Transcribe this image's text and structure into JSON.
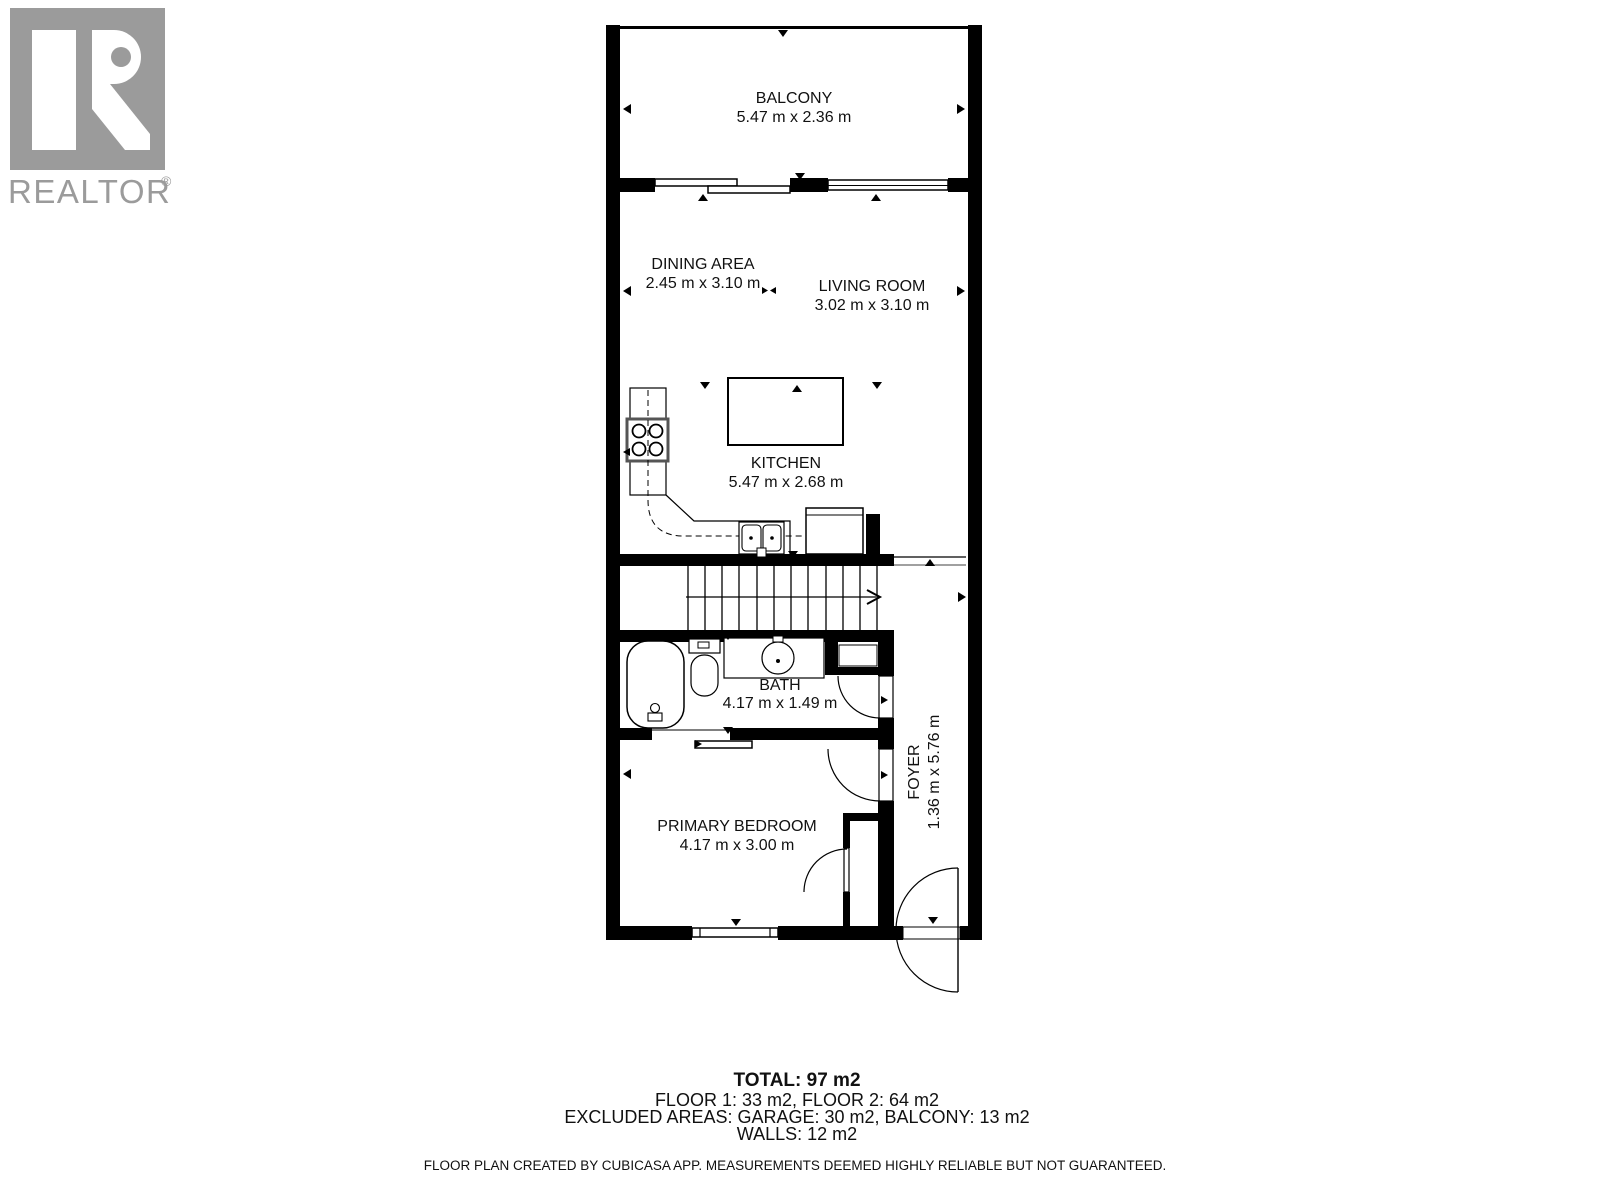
{
  "logo": {
    "brand": "REALTOR",
    "registered": "®",
    "color": "#9b9b9b"
  },
  "rooms": [
    {
      "name": "BALCONY",
      "dims": "5.47 m x 2.36 m"
    },
    {
      "name": "DINING AREA",
      "dims": "2.45 m x 3.10 m"
    },
    {
      "name": "LIVING ROOM",
      "dims": "3.02 m x 3.10 m"
    },
    {
      "name": "KITCHEN",
      "dims": "5.47 m x 2.68 m"
    },
    {
      "name": "BATH",
      "dims": "4.17 m x 1.49 m"
    },
    {
      "name": "FOYER",
      "dims": "1.36 m x 5.76 m"
    },
    {
      "name": "PRIMARY BEDROOM",
      "dims": "4.17 m x 3.00 m"
    }
  ],
  "summary": {
    "total": "TOTAL: 97 m2",
    "floors": "FLOOR 1: 33 m2, FLOOR 2: 64 m2",
    "excluded": "EXCLUDED AREAS: GARAGE: 30 m2, BALCONY: 13 m2",
    "walls": "WALLS: 12 m2"
  },
  "footer": {
    "text": "FLOOR PLAN CREATED BY CUBICASA APP. MEASUREMENTS DEEMED HIGHLY RELIABLE BUT NOT GUARANTEED."
  },
  "colors": {
    "walls": "#000000",
    "background": "#ffffff"
  }
}
